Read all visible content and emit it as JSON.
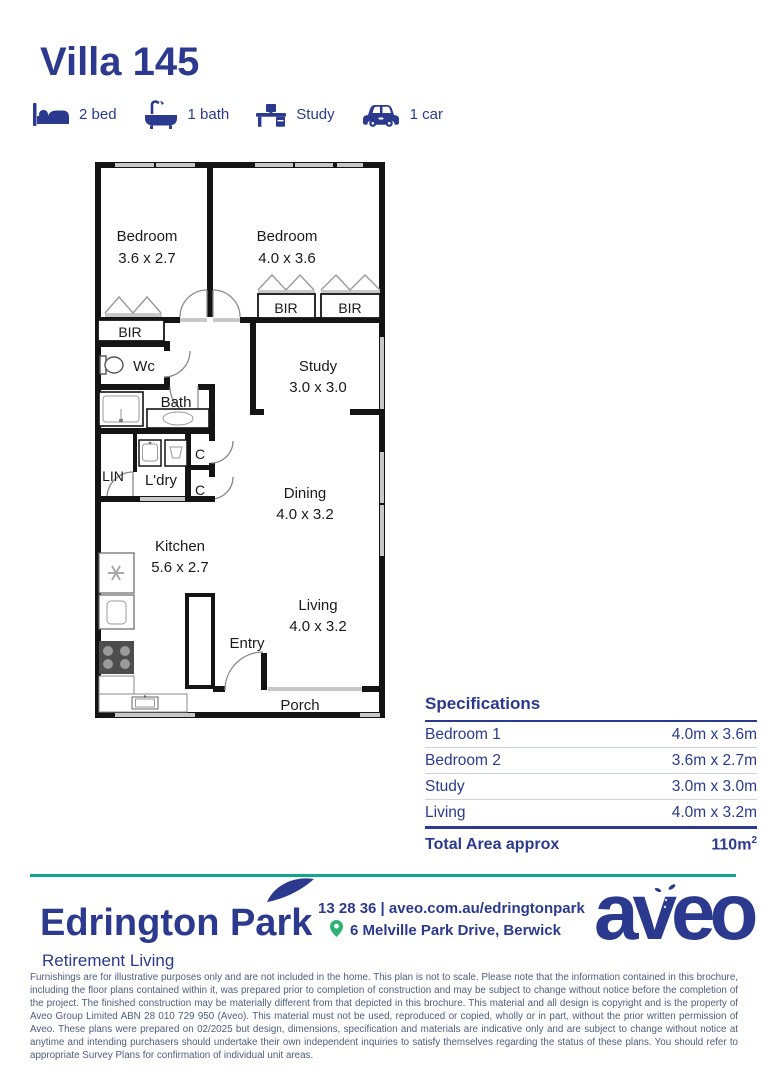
{
  "colors": {
    "navy": "#2B3A8E",
    "teal": "#12A68D",
    "green": "#2FB375",
    "wall_black": "#141414",
    "window_gray": "#C8C8C8",
    "legal_text": "#4E5D7C"
  },
  "header": {
    "title": "Villa 145"
  },
  "features": [
    {
      "icon": "bed-icon",
      "label": "2 bed"
    },
    {
      "icon": "bath-icon",
      "label": "1 bath"
    },
    {
      "icon": "desk-icon",
      "label": "Study"
    },
    {
      "icon": "car-icon",
      "label": "1 car"
    }
  ],
  "floorplan": {
    "rooms": {
      "bedroom1": {
        "name": "Bedroom",
        "dims": "3.6 x 2.7"
      },
      "bedroom2": {
        "name": "Bedroom",
        "dims": "4.0 x 3.6"
      },
      "study": {
        "name": "Study",
        "dims": "3.0 x 3.0"
      },
      "dining": {
        "name": "Dining",
        "dims": "4.0 x 3.2"
      },
      "kitchen": {
        "name": "Kitchen",
        "dims": "5.6 x 2.7"
      },
      "living": {
        "name": "Living",
        "dims": "4.0 x 3.2"
      }
    },
    "labels": {
      "bir": "BIR",
      "wc": "Wc",
      "bath": "Bath",
      "lin": "LIN",
      "ldry": "L'dry",
      "cupboard": "C",
      "entry": "Entry",
      "porch": "Porch"
    }
  },
  "specifications": {
    "title": "Specifications",
    "rows": [
      {
        "label": "Bedroom 1",
        "value": "4.0m x 3.6m"
      },
      {
        "label": "Bedroom 2",
        "value": "3.6m x 2.7m"
      },
      {
        "label": "Study",
        "value": "3.0m x 3.0m"
      },
      {
        "label": "Living",
        "value": "4.0m x 3.2m"
      }
    ],
    "total": {
      "label": "Total Area approx",
      "value": "110m",
      "sup": "2"
    }
  },
  "footer": {
    "brand": "Edrington Park",
    "tagline": "Retirement Living",
    "phone_and_url": "13 28 36 | aveo.com.au/edringtonpark",
    "address": "6 Melville Park Drive, Berwick",
    "logo_text": "aveo"
  },
  "legal": "Furnishings are for illustrative purposes only and are not included in the home. This plan is not to scale. Please note that the information contained in this brochure, including the floor plans contained within it, was prepared prior to completion of construction and may be subject to change without notice before the completion of the project. The finished construction may be materially different from that depicted in this brochure. This material and all design is copyright and is the property of Aveo Group Limited ABN 28 010 729 950 (Aveo). This material must not be used, reproduced or copied, wholly or in part, without the prior written permission of Aveo. These plans were prepared on 02/2025 but design, dimensions, specification and materials are indicative only and are subject to change without notice at anytime and intending purchasers should undertake their own independent inquiries to satisfy themselves regarding the status of these plans. You should refer to appropriate Survey Plans for confirmation of individual unit areas."
}
